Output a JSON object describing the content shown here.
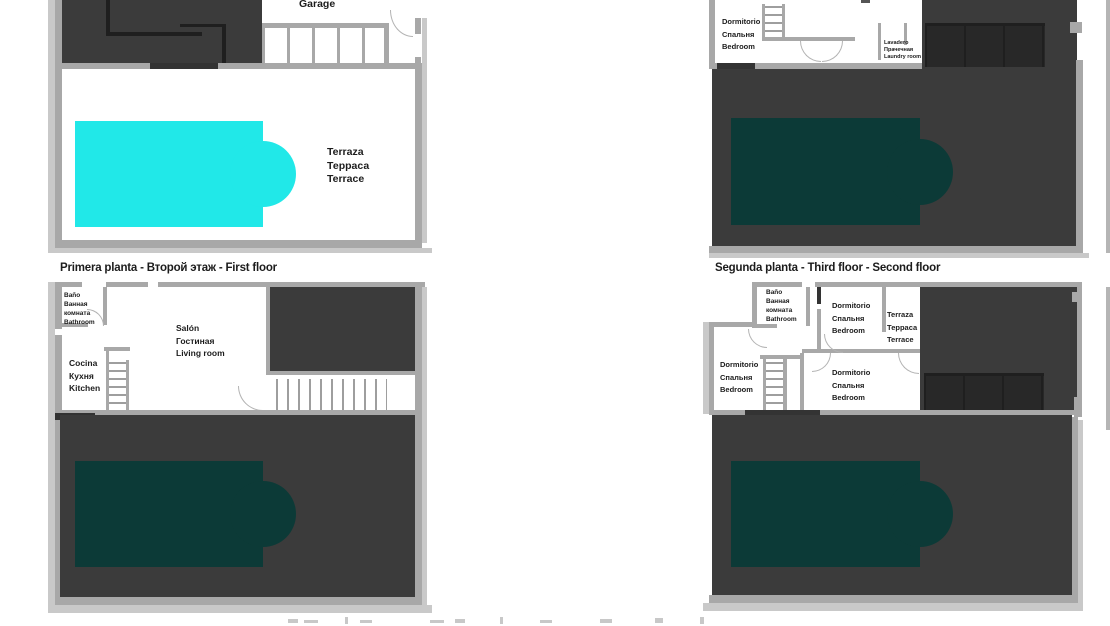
{
  "colors": {
    "wall": "#a8a8a8",
    "wall_light": "#c9c9c9",
    "dark": "#3b3b3b",
    "dark_line": "#1f1f1f",
    "sill": "#333333",
    "tread": "#9e9e9e",
    "arc": "#b3b3b3",
    "pool_cyan": "#21e8e8",
    "pool_teal": "#0c3a37",
    "text": "#1c1c1c",
    "fragment": "#9b9b9b"
  },
  "plan_ground_floor": {
    "garage_label": "Garage",
    "terrace_label": [
      "Terraza",
      "Терраса",
      "Terrace"
    ]
  },
  "plan_first_floor": {
    "caption": "Primera planta - Второй этаж - First floor",
    "bathroom_label": [
      "Baño",
      "Ванная",
      "комната",
      "Bathroom"
    ],
    "living_room_label": [
      "Salón",
      "Гостиная",
      "Living room"
    ],
    "kitchen_label": [
      "Cocina",
      "Кухня",
      "Kitchen"
    ]
  },
  "plan_top_right": {
    "bedroom_label": [
      "Dormitorio",
      "Спальня",
      "Bedroom"
    ],
    "laundry_label": [
      "Lavadero",
      "Прачечная",
      "Laundry room"
    ]
  },
  "plan_second_floor": {
    "caption": "Segunda planta - Third floor - Second floor",
    "bathroom_label": [
      "Baño",
      "Ванная",
      "комната",
      "Bathroom"
    ],
    "bedroom_top_label": [
      "Dormitorio",
      "Спальня",
      "Bedroom"
    ],
    "terrace_label": [
      "Terraza",
      "Терраса",
      "Terrace"
    ],
    "bedroom_left_label": [
      "Dormitorio",
      "Спальня",
      "Bedroom"
    ],
    "bedroom_center_label": [
      "Dormitorio",
      "Спальня",
      "Bedroom"
    ]
  }
}
